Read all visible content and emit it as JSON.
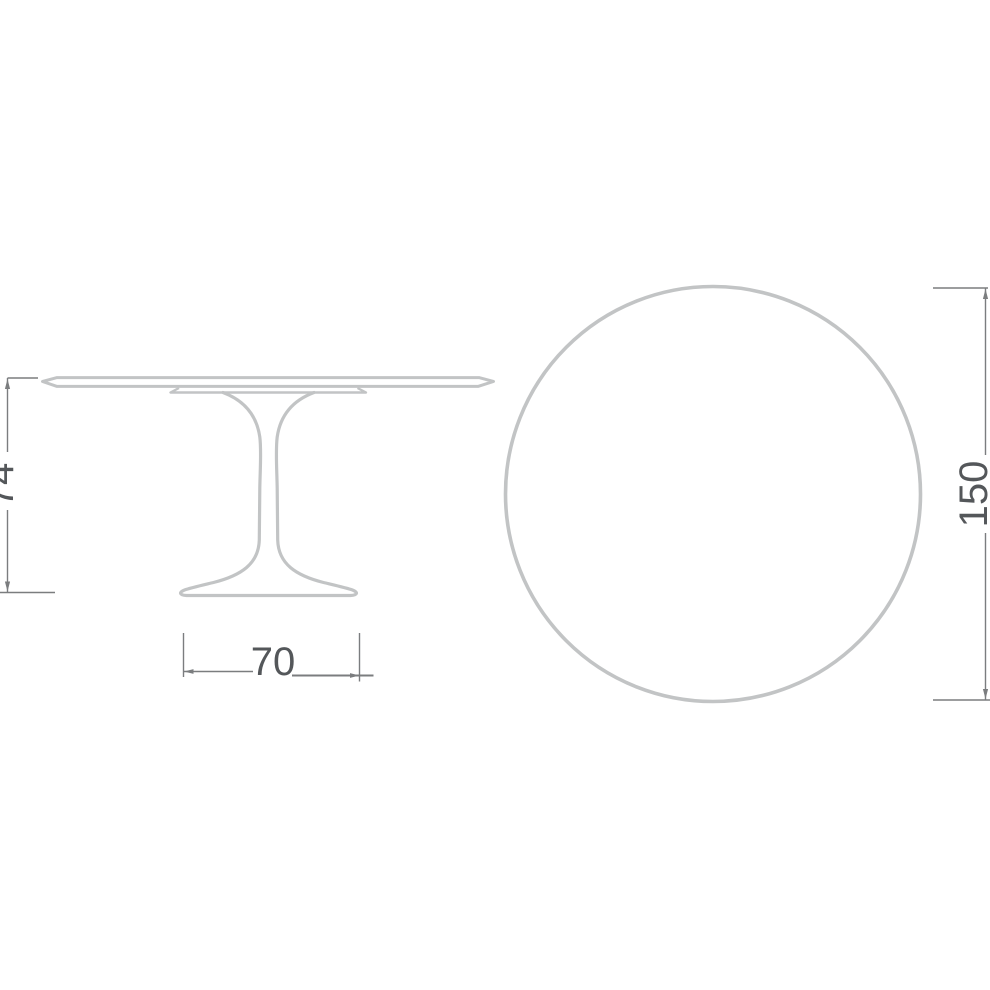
{
  "drawing": {
    "subject": "round-pedestal-table-dimension-diagram",
    "views": [
      {
        "id": "side_elevation",
        "name": "table-side-elevation-view"
      },
      {
        "id": "top_plan",
        "name": "table-top-plan-view"
      }
    ],
    "dimensions": {
      "height": {
        "label": "74",
        "orientation": "vertical",
        "view": "side_elevation"
      },
      "base_width": {
        "label": "70",
        "orientation": "horizontal",
        "view": "side_elevation"
      },
      "top_diameter": {
        "label": "150",
        "orientation": "vertical",
        "view": "top_plan"
      }
    },
    "colors": {
      "background": "#ffffff",
      "outline": "#c2c4c5",
      "dimension_line": "#7b7d7f",
      "label_text": "#54575a"
    }
  }
}
